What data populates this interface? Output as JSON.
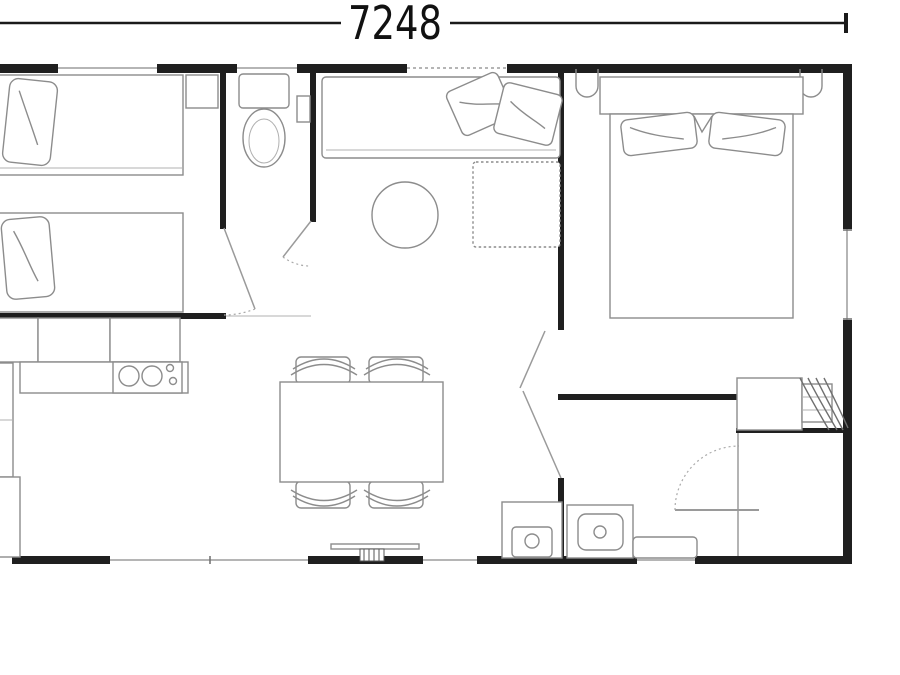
{
  "dimension": {
    "value": "7248"
  },
  "colors": {
    "wall": "#1f1f1f",
    "furniture_line": "#8c8c8c",
    "window_line": "#b5b5b5",
    "door_line": "#9a9a9a",
    "dimension_text": "#111111",
    "background": "#ffffff"
  },
  "icons": {
    "dimension_marker": "dimension-end-tick",
    "fixtures": [
      "single-bed",
      "pillow",
      "nightstand",
      "toilet",
      "wall-shelf",
      "sofa",
      "sofa-cushion",
      "chaise-ottoman",
      "coffee-table",
      "kitchen-wall-cabinet",
      "kitchen-counter",
      "hob-sink-unit",
      "dining-table",
      "dining-chair",
      "double-bed",
      "headboard",
      "bedside-sconce",
      "water-heater",
      "shower",
      "washbasin",
      "storage-bench",
      "entry-step",
      "door-swing",
      "folding-door",
      "window"
    ]
  }
}
